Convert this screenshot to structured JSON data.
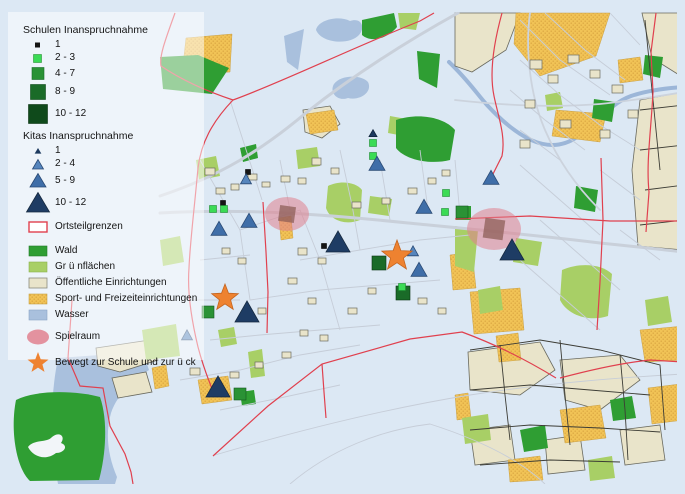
{
  "legend": {
    "schulen": {
      "title": "Schulen Inanspruchnahme",
      "items": [
        {
          "label": "1"
        },
        {
          "label": "2 - 3"
        },
        {
          "label": "4 - 7"
        },
        {
          "label": "8 - 9"
        },
        {
          "label": "10 - 12"
        }
      ]
    },
    "kitas": {
      "title": "Kitas Inanspruchnahme",
      "items": [
        {
          "label": "1"
        },
        {
          "label": "2 - 4"
        },
        {
          "label": "5 - 9"
        },
        {
          "label": "10 - 12"
        }
      ]
    },
    "boundary_label": "Ortsteilgrenzen",
    "areas": [
      {
        "label": "Wald"
      },
      {
        "label": "Gr ü nflächen"
      },
      {
        "label": "Öffentliche Einrichtungen"
      },
      {
        "label": "Sport- und Freizeiteinrichtungen"
      },
      {
        "label": "Wasser"
      }
    ],
    "spielraum_label": "Spielraum",
    "star_label": "Bewegt zur Schule und zur ü ck"
  },
  "colors": {
    "bg": "#dce8f4",
    "water": "#a9c0dd",
    "river": "#9cb6d8",
    "wald": "#2f9e33",
    "gruen": "#a8cf66",
    "beige": "#e9e4ca",
    "sport": "#f1c356",
    "sportdot": "#d9a440",
    "road": "#c9d0da",
    "boundary": "#e0404e",
    "spielraum": "#e0808e",
    "spielraum_core": "#8a5c55",
    "star": "#ee8230",
    "school1": "#141414",
    "school2": "#3bdb55",
    "school3": "#2a9235",
    "school4": "#1a6b28",
    "school5": "#0f4a1b",
    "kita1": "#1d3a5f",
    "kita2": "#5585bd",
    "kita3": "#3f6ea8",
    "kita4": "#1e3c64"
  },
  "map_markers": {
    "schulen": [
      [
        248,
        172,
        "1"
      ],
      [
        223,
        203,
        "1"
      ],
      [
        324,
        246,
        "1"
      ],
      [
        213,
        209,
        "2-3"
      ],
      [
        224,
        209,
        "2-3"
      ],
      [
        373,
        143,
        "2-3"
      ],
      [
        373,
        156,
        "2-3"
      ],
      [
        446,
        193,
        "2-3"
      ],
      [
        445,
        212,
        "2-3"
      ],
      [
        403,
        293,
        "8-9"
      ],
      [
        402,
        287,
        "2-3"
      ],
      [
        462,
        212,
        "4-7"
      ],
      [
        208,
        312,
        "4-7"
      ],
      [
        240,
        394,
        "4-7"
      ],
      [
        379,
        263,
        "8-9"
      ]
    ],
    "kitas": [
      [
        246,
        180,
        "2-4"
      ],
      [
        373,
        134,
        "1"
      ],
      [
        377,
        165,
        "5-9"
      ],
      [
        424,
        208,
        "5-9"
      ],
      [
        491,
        179,
        "5-9"
      ],
      [
        249,
        222,
        "5-9"
      ],
      [
        219,
        230,
        "5-9"
      ],
      [
        413,
        252,
        "2-4"
      ],
      [
        419,
        271,
        "5-9"
      ],
      [
        338,
        244,
        "10-12"
      ],
      [
        512,
        252,
        "10-12"
      ],
      [
        247,
        314,
        "10-12"
      ],
      [
        187,
        336,
        "2-4"
      ],
      [
        218,
        389,
        "10-12"
      ]
    ],
    "spielraum": [
      [
        287,
        214,
        22,
        17,
        16
      ],
      [
        494,
        229,
        27,
        21,
        20
      ]
    ],
    "stars": [
      [
        225,
        298,
        14
      ],
      [
        397,
        256,
        16
      ]
    ]
  }
}
